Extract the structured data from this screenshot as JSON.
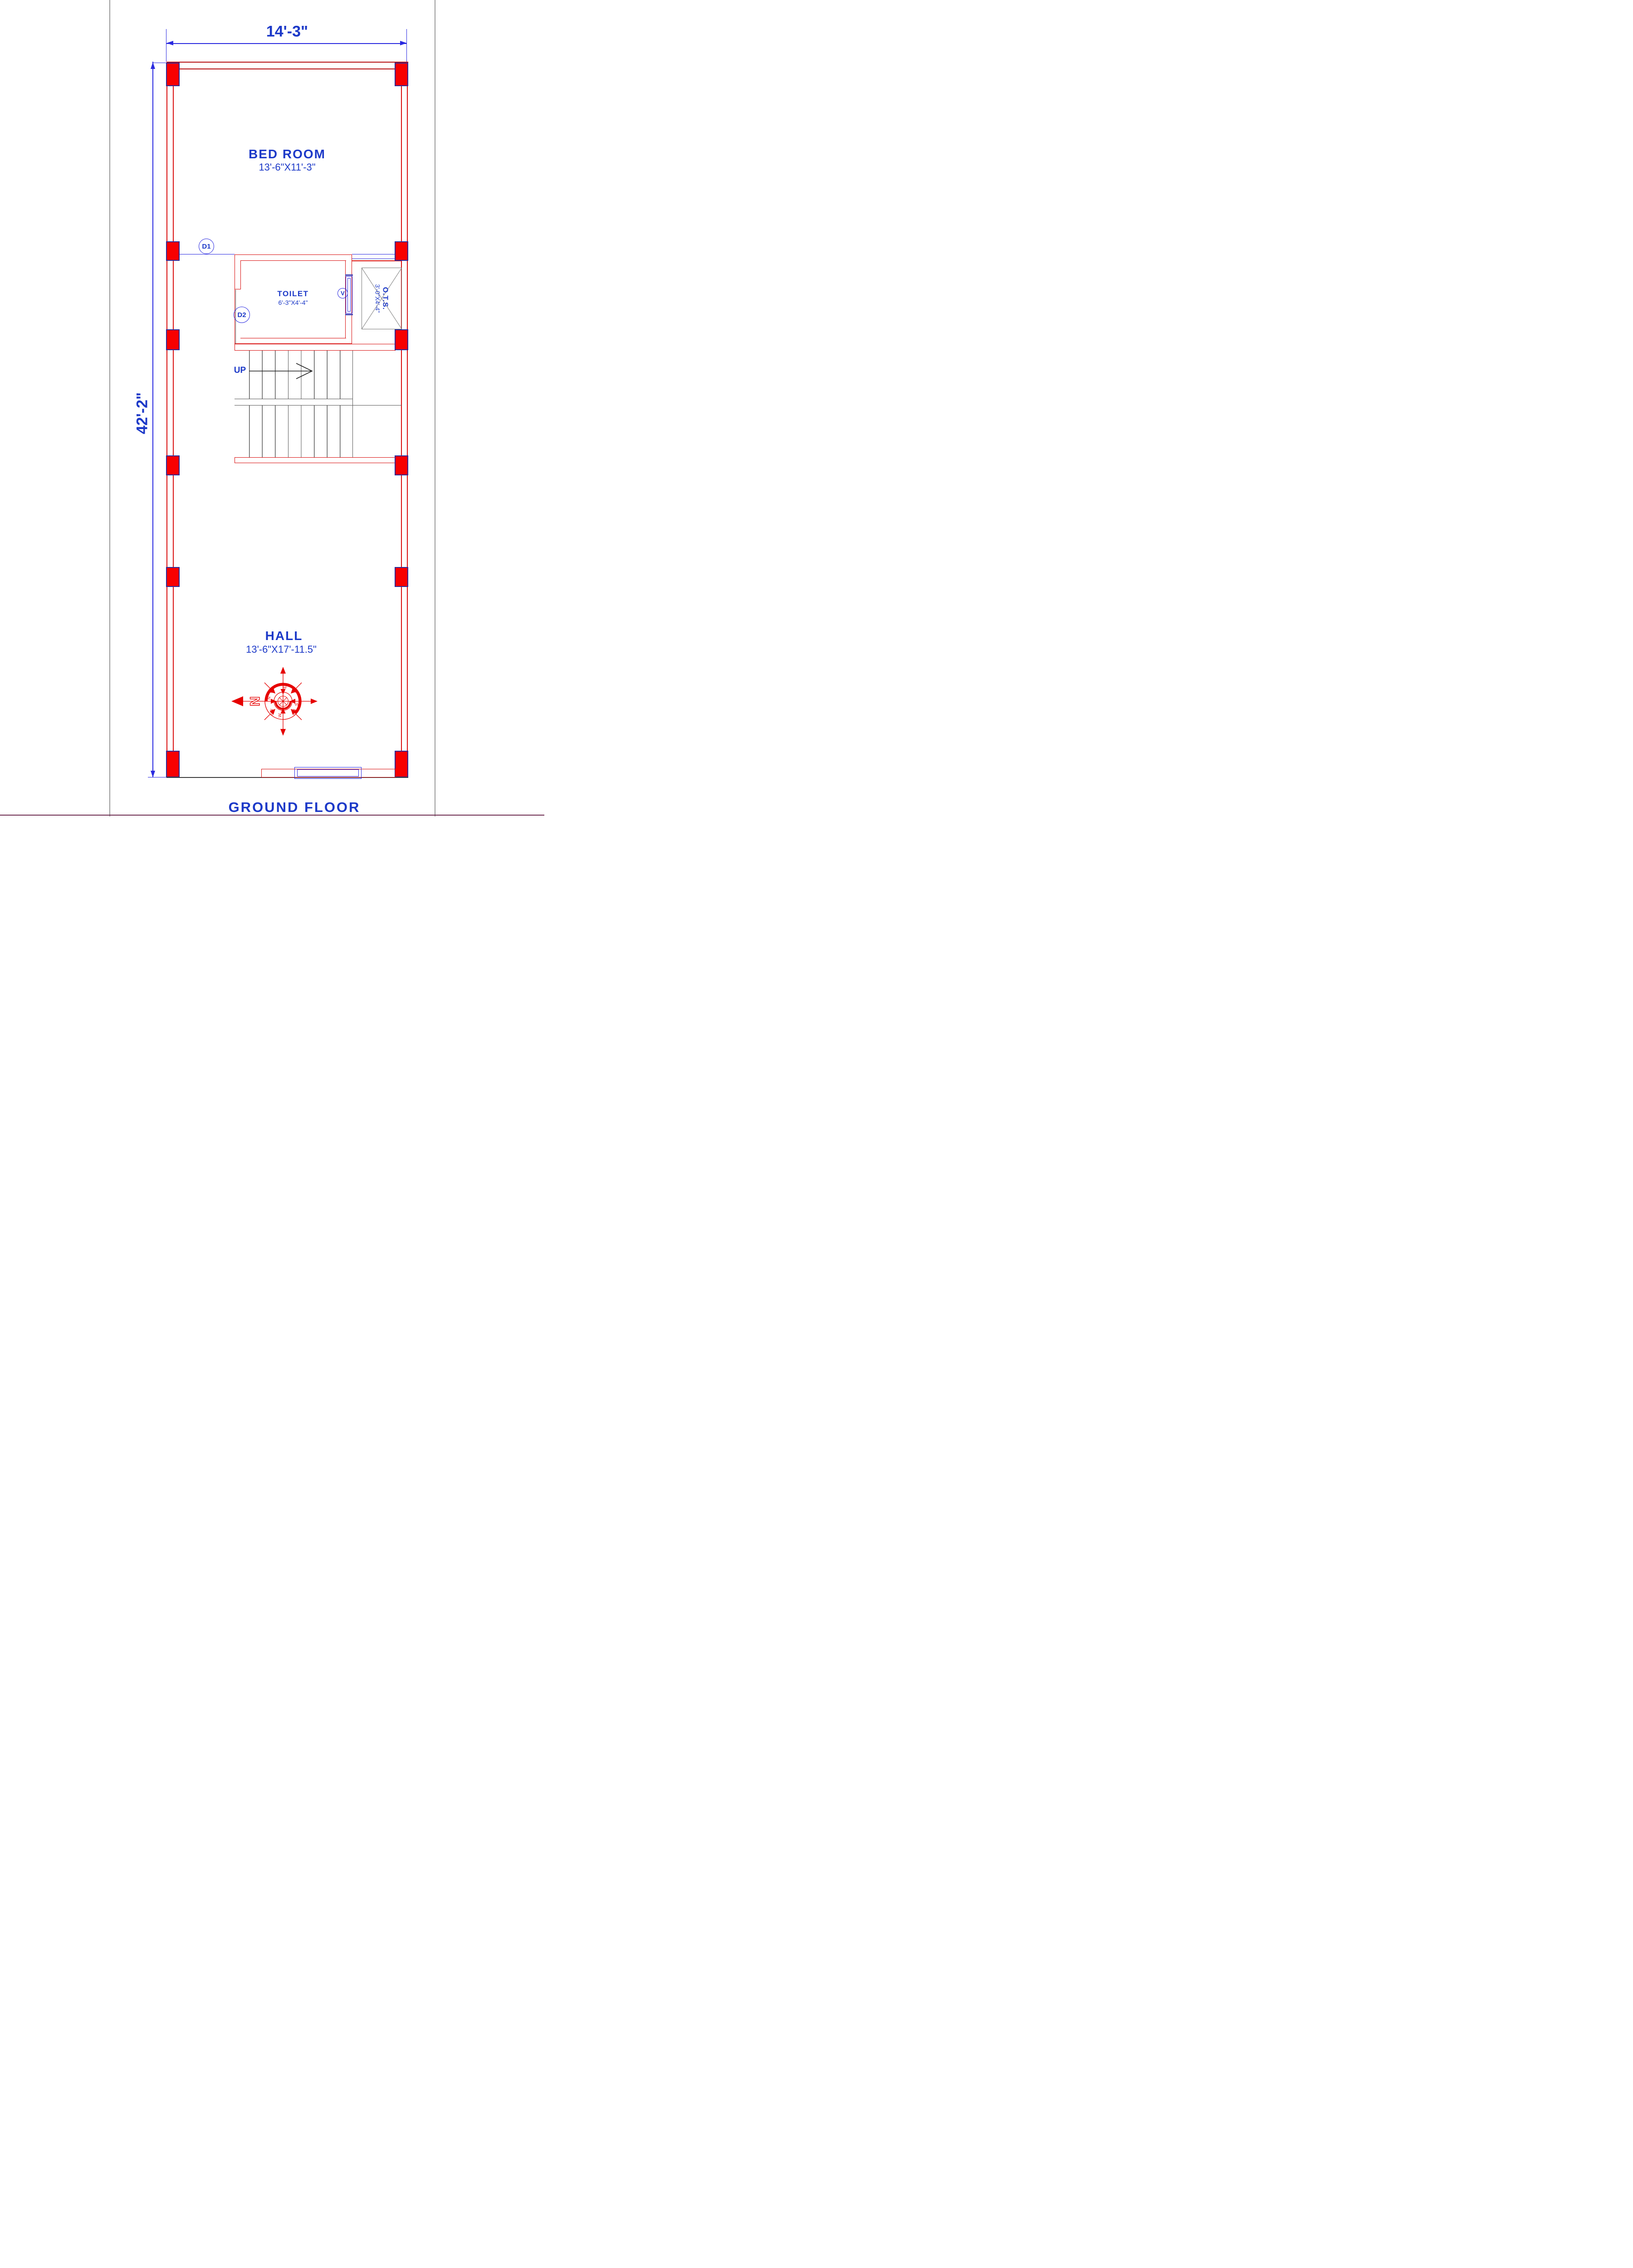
{
  "sheet": {
    "floor_title": "GROUND FLOOR"
  },
  "dimensions": {
    "top_width_label": "14'-3\"",
    "left_height_label": "42'-2\""
  },
  "rooms": {
    "bedroom": {
      "name": "BED ROOM",
      "size": "13'-6\"X11'-3\""
    },
    "toilet": {
      "name": "TOILET",
      "size": "6'-3\"X4'-4\""
    },
    "ots": {
      "name": "O.T.S.",
      "size": "3'-0\"X4'-4\""
    },
    "hall": {
      "name": "HALL",
      "size": "13'-6\"X17'-11.5\""
    }
  },
  "stair": {
    "direction_label": "UP"
  },
  "openings": {
    "door1_label": "D1",
    "door2_label": "D2",
    "ventilator_label": "V"
  },
  "compass": {
    "north_letter": "N",
    "cardinals": {
      "n": "N",
      "s": "S",
      "e": "E",
      "w": "W",
      "ne": "NE",
      "se": "SE",
      "nw": "NW",
      "sw": "SW"
    }
  },
  "colors": {
    "wall_red": "#d90f0f",
    "column_fill": "#f80000",
    "column_border": "#2b2b9a",
    "dimension_blue": "#2a2ae0",
    "text_blue": "#1c39c8",
    "stair_gray": "#5a5a5a",
    "ots_gray": "#7a7a7a",
    "sheet_border_gray": "#9a9a9a"
  }
}
